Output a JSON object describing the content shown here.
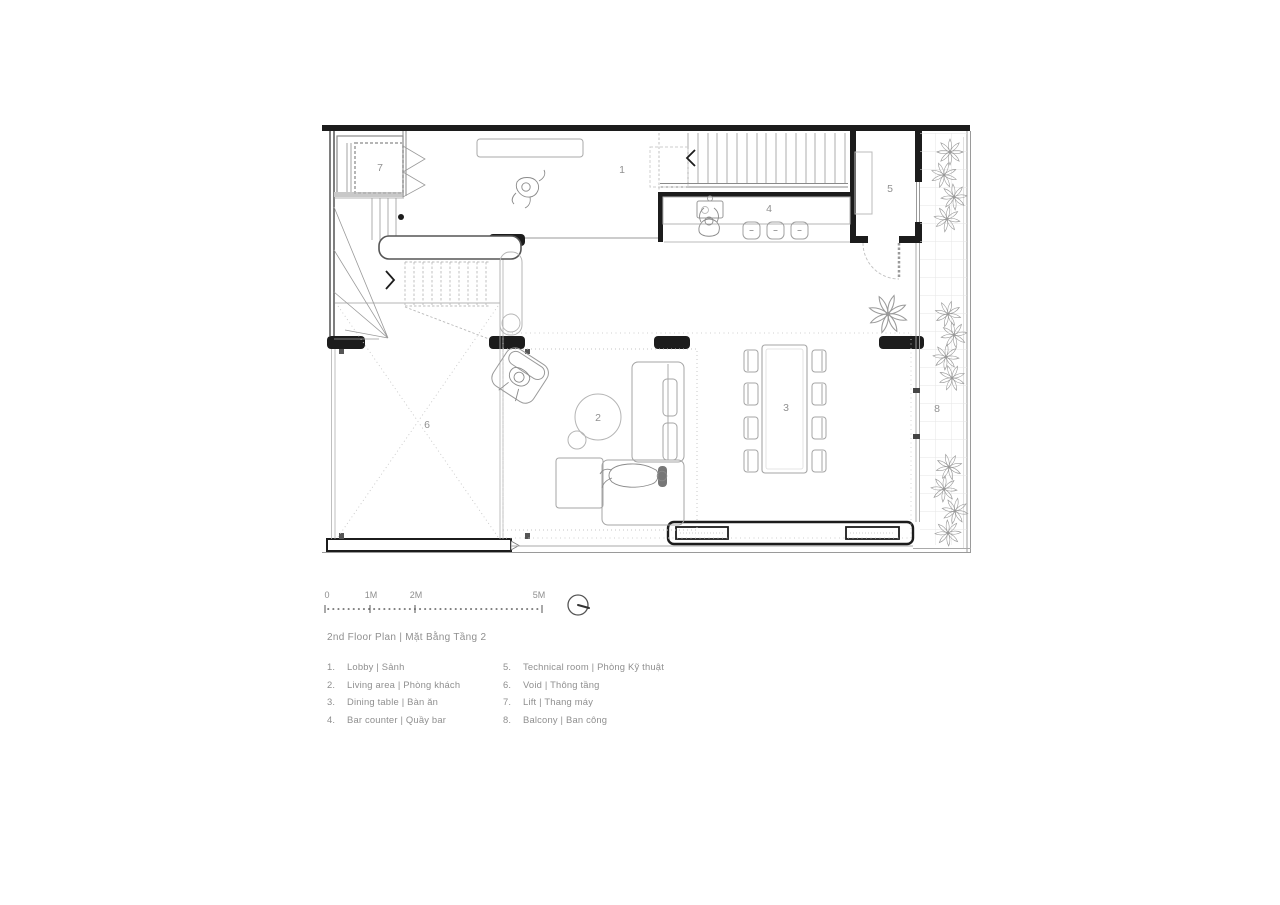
{
  "title": "2nd Floor Plan | Mặt Bằng Tầng 2",
  "scale_bar": {
    "ticks": [
      "0",
      "1M",
      "2M",
      "5M"
    ]
  },
  "north_indicator": "north-direction-dial",
  "drawing": {
    "room_labels": [
      {
        "id": "1",
        "room": "lobby"
      },
      {
        "id": "2",
        "room": "living-area"
      },
      {
        "id": "3",
        "room": "dining-table"
      },
      {
        "id": "4",
        "room": "bar-counter"
      },
      {
        "id": "5",
        "room": "technical-room"
      },
      {
        "id": "6",
        "room": "void"
      },
      {
        "id": "7",
        "room": "lift"
      },
      {
        "id": "8",
        "room": "balcony"
      }
    ],
    "colors": {
      "wall": "#1c1c1c",
      "line_medium": "#8a8a8a",
      "line_light": "#b5b5b5",
      "grid": "#e6e6e6",
      "text": "#8f8f8f"
    }
  },
  "legend": {
    "column1": [
      {
        "num": "1.",
        "label": "Lobby | Sảnh"
      },
      {
        "num": "2.",
        "label": "Living area | Phòng khách"
      },
      {
        "num": "3.",
        "label": "Dining table | Bàn ăn"
      },
      {
        "num": "4.",
        "label": "Bar counter | Quầy bar"
      }
    ],
    "column2": [
      {
        "num": "5.",
        "label": "Technical room | Phòng Kỹ thuật"
      },
      {
        "num": "6.",
        "label": "Void | Thông tầng"
      },
      {
        "num": "7.",
        "label": "Lift | Thang máy"
      },
      {
        "num": "8.",
        "label": "Balcony | Ban công"
      }
    ]
  }
}
